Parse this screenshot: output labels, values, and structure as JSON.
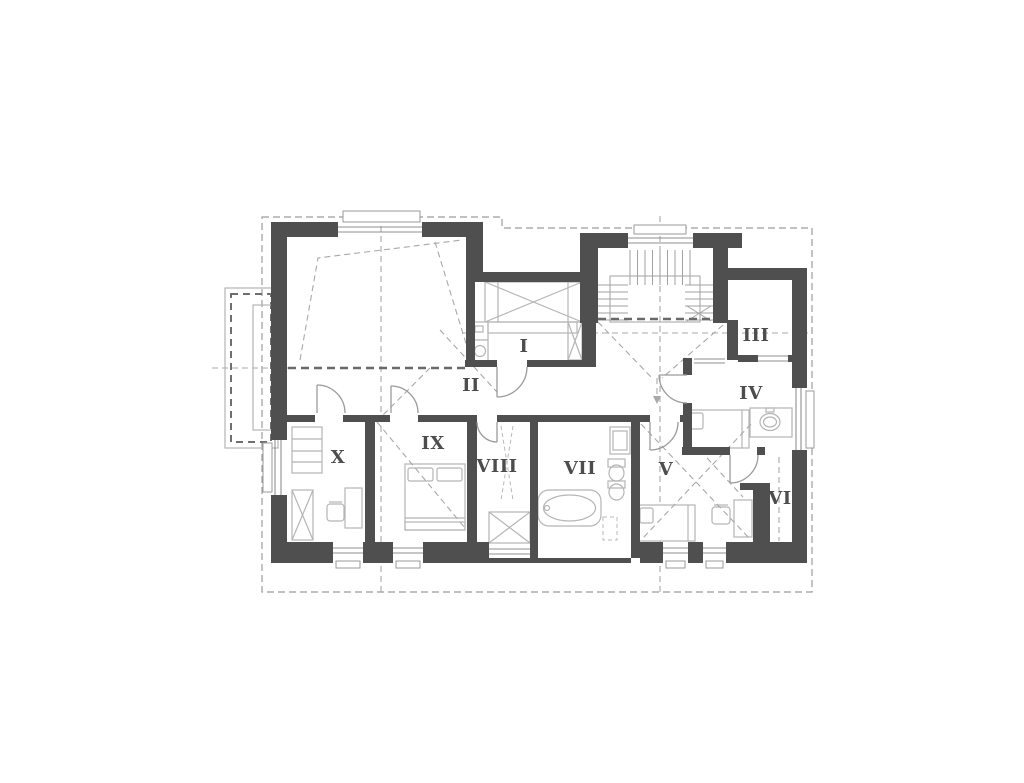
{
  "plan": {
    "type": "floor-plan",
    "rooms": [
      {
        "label": "I"
      },
      {
        "label": "II"
      },
      {
        "label": "III"
      },
      {
        "label": "IV"
      },
      {
        "label": "V"
      },
      {
        "label": "VI"
      },
      {
        "label": "VII"
      },
      {
        "label": "VIII"
      },
      {
        "label": "IX"
      },
      {
        "label": "X"
      }
    ],
    "colors": {
      "wall": "#4f4f4f",
      "furniture_line": "#b5b5b5",
      "window_line": "#8f8f8f",
      "door_arc": "#9a9a9a",
      "axis_dash": "#a8a8a8",
      "knee_wall_dash": "#696969",
      "boundary_dash": "#9c9c9c",
      "label_text": "#4d4d4d",
      "background": "#ffffff"
    }
  }
}
